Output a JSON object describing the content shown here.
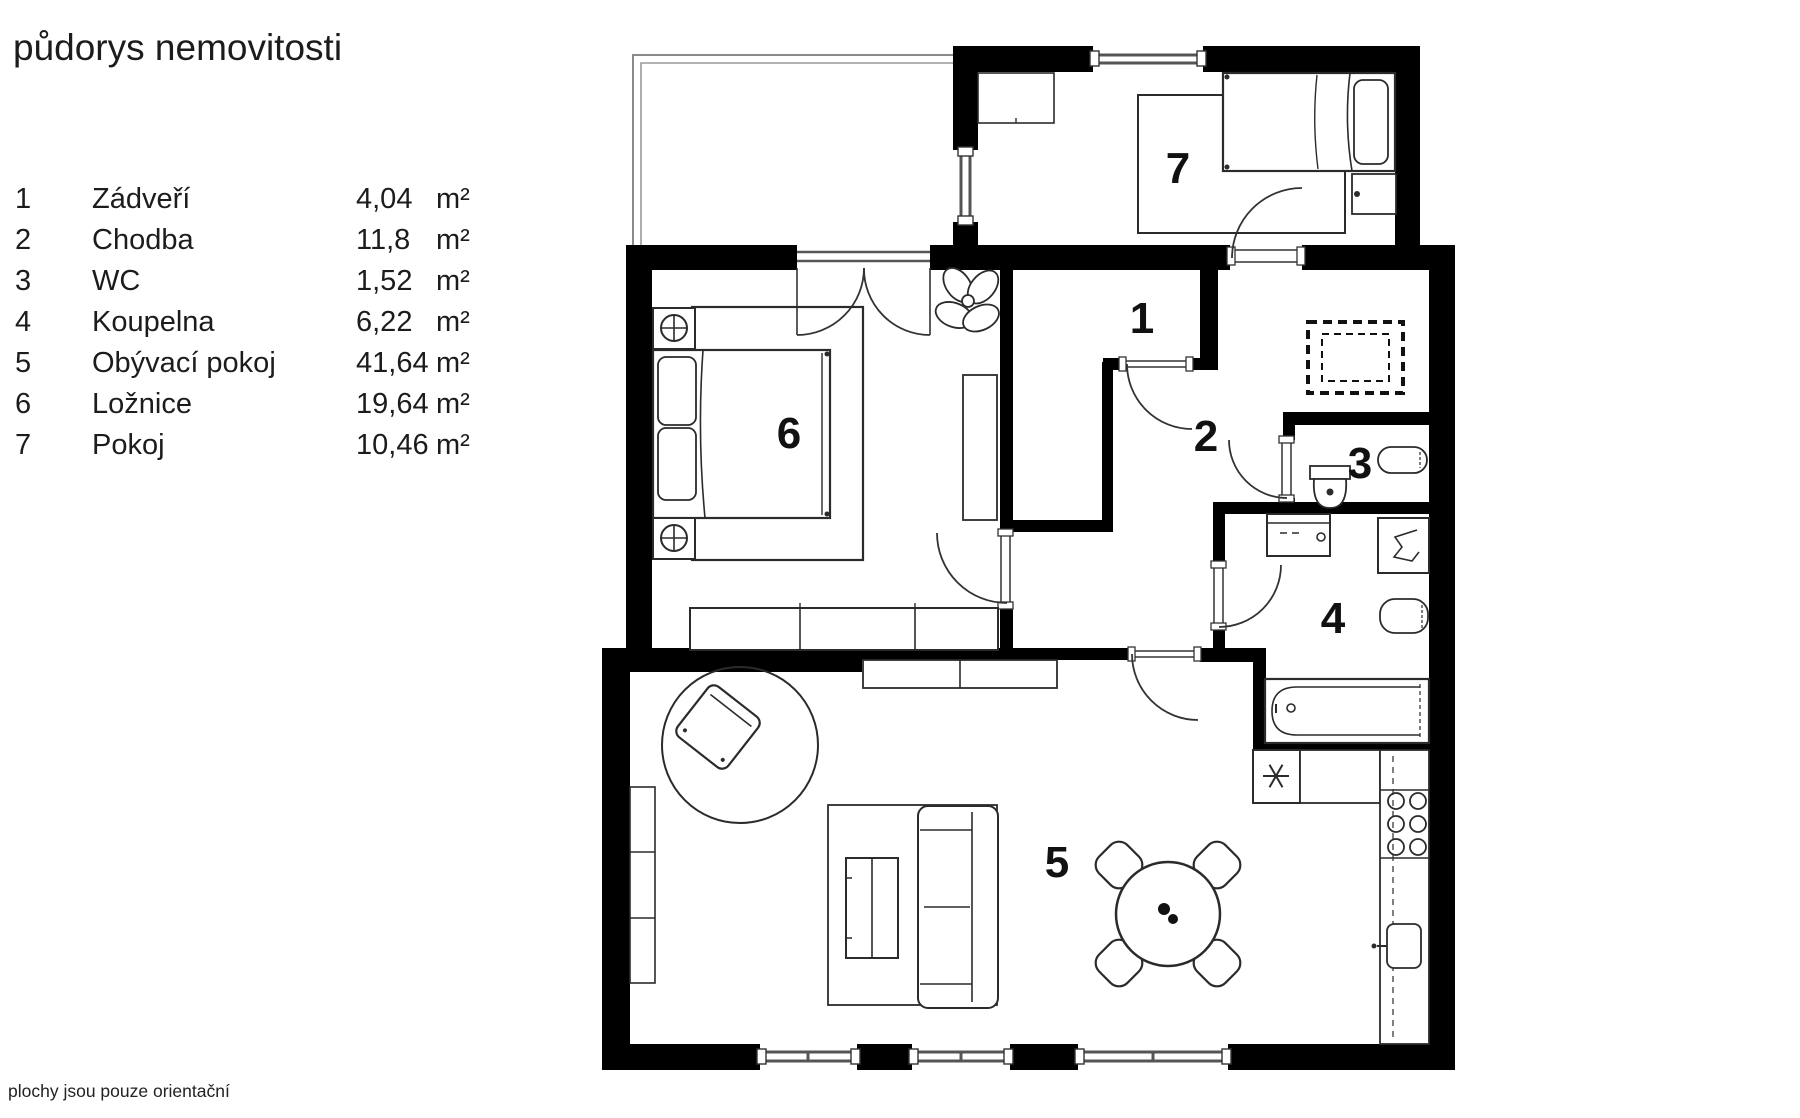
{
  "title": "půdorys nemovitosti",
  "footer_note": "plochy jsou pouze orientační",
  "legend": {
    "rows": [
      {
        "num": "1",
        "name": "Zádveří",
        "area": "4,04",
        "unit": "m²"
      },
      {
        "num": "2",
        "name": "Chodba",
        "area": "11,8",
        "unit": "m²"
      },
      {
        "num": "3",
        "name": "WC",
        "area": "1,52",
        "unit": "m²"
      },
      {
        "num": "4",
        "name": "Koupelna",
        "area": "6,22",
        "unit": "m²"
      },
      {
        "num": "5",
        "name": "Obývací pokoj",
        "area": "41,64",
        "unit": "m²"
      },
      {
        "num": "6",
        "name": "Ložnice",
        "area": "19,64",
        "unit": "m²"
      },
      {
        "num": "7",
        "name": "Pokoj",
        "area": "10,46",
        "unit": "m²"
      }
    ]
  },
  "plan": {
    "room_labels": {
      "r1": "1",
      "r2": "2",
      "r3": "3",
      "r4": "4",
      "r5": "5",
      "r6": "6",
      "r7": "7"
    }
  },
  "colors": {
    "wall": "#000000",
    "text": "#1c1c1c",
    "furniture_stroke": "#2b2b2b",
    "window": "#6e6e6e"
  }
}
